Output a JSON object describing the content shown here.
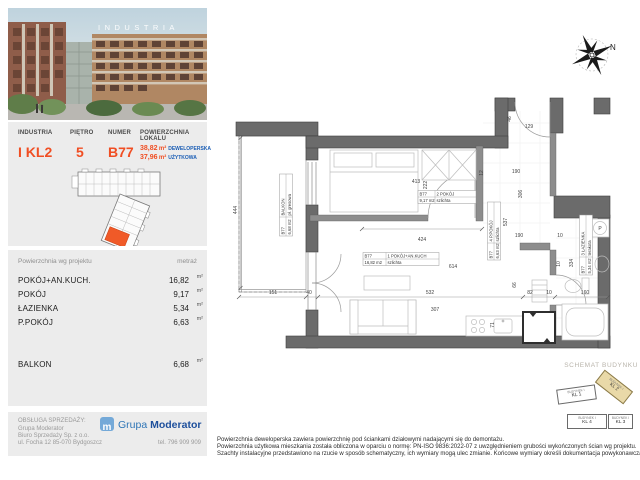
{
  "accent_orange": "#f04e23",
  "accent_blue": "#1b5eb5",
  "photo": {
    "overlay_text": "INDUSTRIA"
  },
  "info_table": {
    "headers": [
      "INDUSTRIA",
      "PIĘTRO",
      "NUMER",
      "POWIERZCHNIA LOKALU"
    ],
    "building": "I KL2",
    "floor": "5",
    "number": "B77",
    "area_dev": "38,82",
    "area_dev_label": "DEWELOPERSKA",
    "area_use": "37,96",
    "area_use_label": "UŻYTKOWA",
    "unit": "m²"
  },
  "area_table": {
    "col1": "Powierzchnia wg projektu",
    "col2": "metraż",
    "rows": [
      {
        "label": "POKÓJ+AN.KUCH.",
        "value": "16,82"
      },
      {
        "label": "POKÓJ",
        "value": "9,17"
      },
      {
        "label": "ŁAZIENKA",
        "value": "5,34"
      },
      {
        "label": "P.POKÓJ",
        "value": "6,63"
      }
    ],
    "balcony_row": {
      "label": "BALKON",
      "value": "6,68"
    },
    "unit": "m²"
  },
  "footer": {
    "sales_label": "OBSŁUGA SPRZEDAŻY:",
    "company": "Grupa Moderator",
    "office": "Biuro Sprzedaży Sp. z o.o.",
    "address": "ul. Focha 12 85-070 Bydgoszcz",
    "phone": "tel. 796 909 909",
    "logo_m": "m",
    "logo_text_1": "Grupa",
    "logo_text_2": "Moderator"
  },
  "compass": {
    "label": "N"
  },
  "plan": {
    "washer_label": "P",
    "dimensions": [
      {
        "t": "413",
        "x": 186,
        "y": 95
      },
      {
        "t": "222",
        "x": 197,
        "y": 97,
        "r": true
      },
      {
        "t": "12",
        "x": 253,
        "y": 85,
        "r": true
      },
      {
        "t": "424",
        "x": 192,
        "y": 153
      },
      {
        "t": "614",
        "x": 223,
        "y": 180
      },
      {
        "t": "532",
        "x": 200,
        "y": 206
      },
      {
        "t": "151",
        "x": 43,
        "y": 206
      },
      {
        "t": "40",
        "x": 79,
        "y": 206
      },
      {
        "t": "444",
        "x": 7,
        "y": 122,
        "r": true
      },
      {
        "t": "190",
        "x": 286,
        "y": 85
      },
      {
        "t": "46",
        "x": 281,
        "y": 31,
        "r": true
      },
      {
        "t": "129",
        "x": 299,
        "y": 40
      },
      {
        "t": "306",
        "x": 292,
        "y": 106,
        "r": true
      },
      {
        "t": "537",
        "x": 277,
        "y": 134,
        "r": true
      },
      {
        "t": "190",
        "x": 289,
        "y": 149
      },
      {
        "t": "10",
        "x": 330,
        "y": 149
      },
      {
        "t": "10",
        "x": 330,
        "y": 176,
        "r": true
      },
      {
        "t": "334",
        "x": 343,
        "y": 175,
        "r": true
      },
      {
        "t": "66",
        "x": 286,
        "y": 197,
        "r": true
      },
      {
        "t": "71",
        "x": 264,
        "y": 237,
        "r": true
      },
      {
        "t": "82",
        "x": 300,
        "y": 206
      },
      {
        "t": "10",
        "x": 319,
        "y": 206
      },
      {
        "t": "160",
        "x": 355,
        "y": 206
      },
      {
        "t": "307",
        "x": 205,
        "y": 223
      }
    ],
    "rooms": [
      {
        "unit": "B77",
        "name": "2 POKÓJ",
        "area": "9,17 m2",
        "floor": "szlichta",
        "x": 217,
        "y": 109,
        "w": 58,
        "rot": false
      },
      {
        "unit": "B77",
        "name": "1 POKÓJ+AN.KUCH",
        "area": "16,82 m2",
        "floor": "szlichta",
        "x": 171,
        "y": 171,
        "w": 76,
        "rot": false
      },
      {
        "unit": "B77",
        "name": "BALKON",
        "area": "6,68 m2",
        "floor": "pł. gresowa",
        "x": 56,
        "y": 117,
        "w": 62,
        "rot": true
      },
      {
        "unit": "B77",
        "name": "4 P.POKÓJ",
        "area": "6,63 m2",
        "floor": "szlichta",
        "x": 264,
        "y": 143,
        "w": 58,
        "rot": true
      },
      {
        "unit": "B77",
        "name": "3 ŁAZIENKA",
        "area": "5,34 m2",
        "floor": "terakota",
        "x": 356,
        "y": 157,
        "w": 60,
        "rot": true
      }
    ]
  },
  "schemat": {
    "title": "SCHEMAT BUDYNKU",
    "blocks": [
      {
        "sub": "BUDYNEK I",
        "kl": "KL 1"
      },
      {
        "sub": "BUDYNEK I",
        "kl": "KL 4"
      },
      {
        "sub": "BUDYNEK I",
        "kl": "KL 3"
      },
      {
        "sub": "BUDYNEK I",
        "kl": "KL 2"
      }
    ]
  },
  "disclaimer": {
    "lines": [
      "Powierzchnia deweloperska zawiera powierzchnię pod ściankami działowymi nadającymi się do demontażu.",
      "Powierzchnia użytkowa mieszkania została obliczona w oparciu o normę: PN-ISO 9836:2022-07 z uwzględnieniem grubości wykończonych ścian wg projektu.",
      "Szachty instalacyjne przedstawiono na rzucie w sposób schematyczny, ich wymiary mogą ulec zmianie. Końcowe wymiary określi dokumentacja powykonawcza."
    ]
  }
}
